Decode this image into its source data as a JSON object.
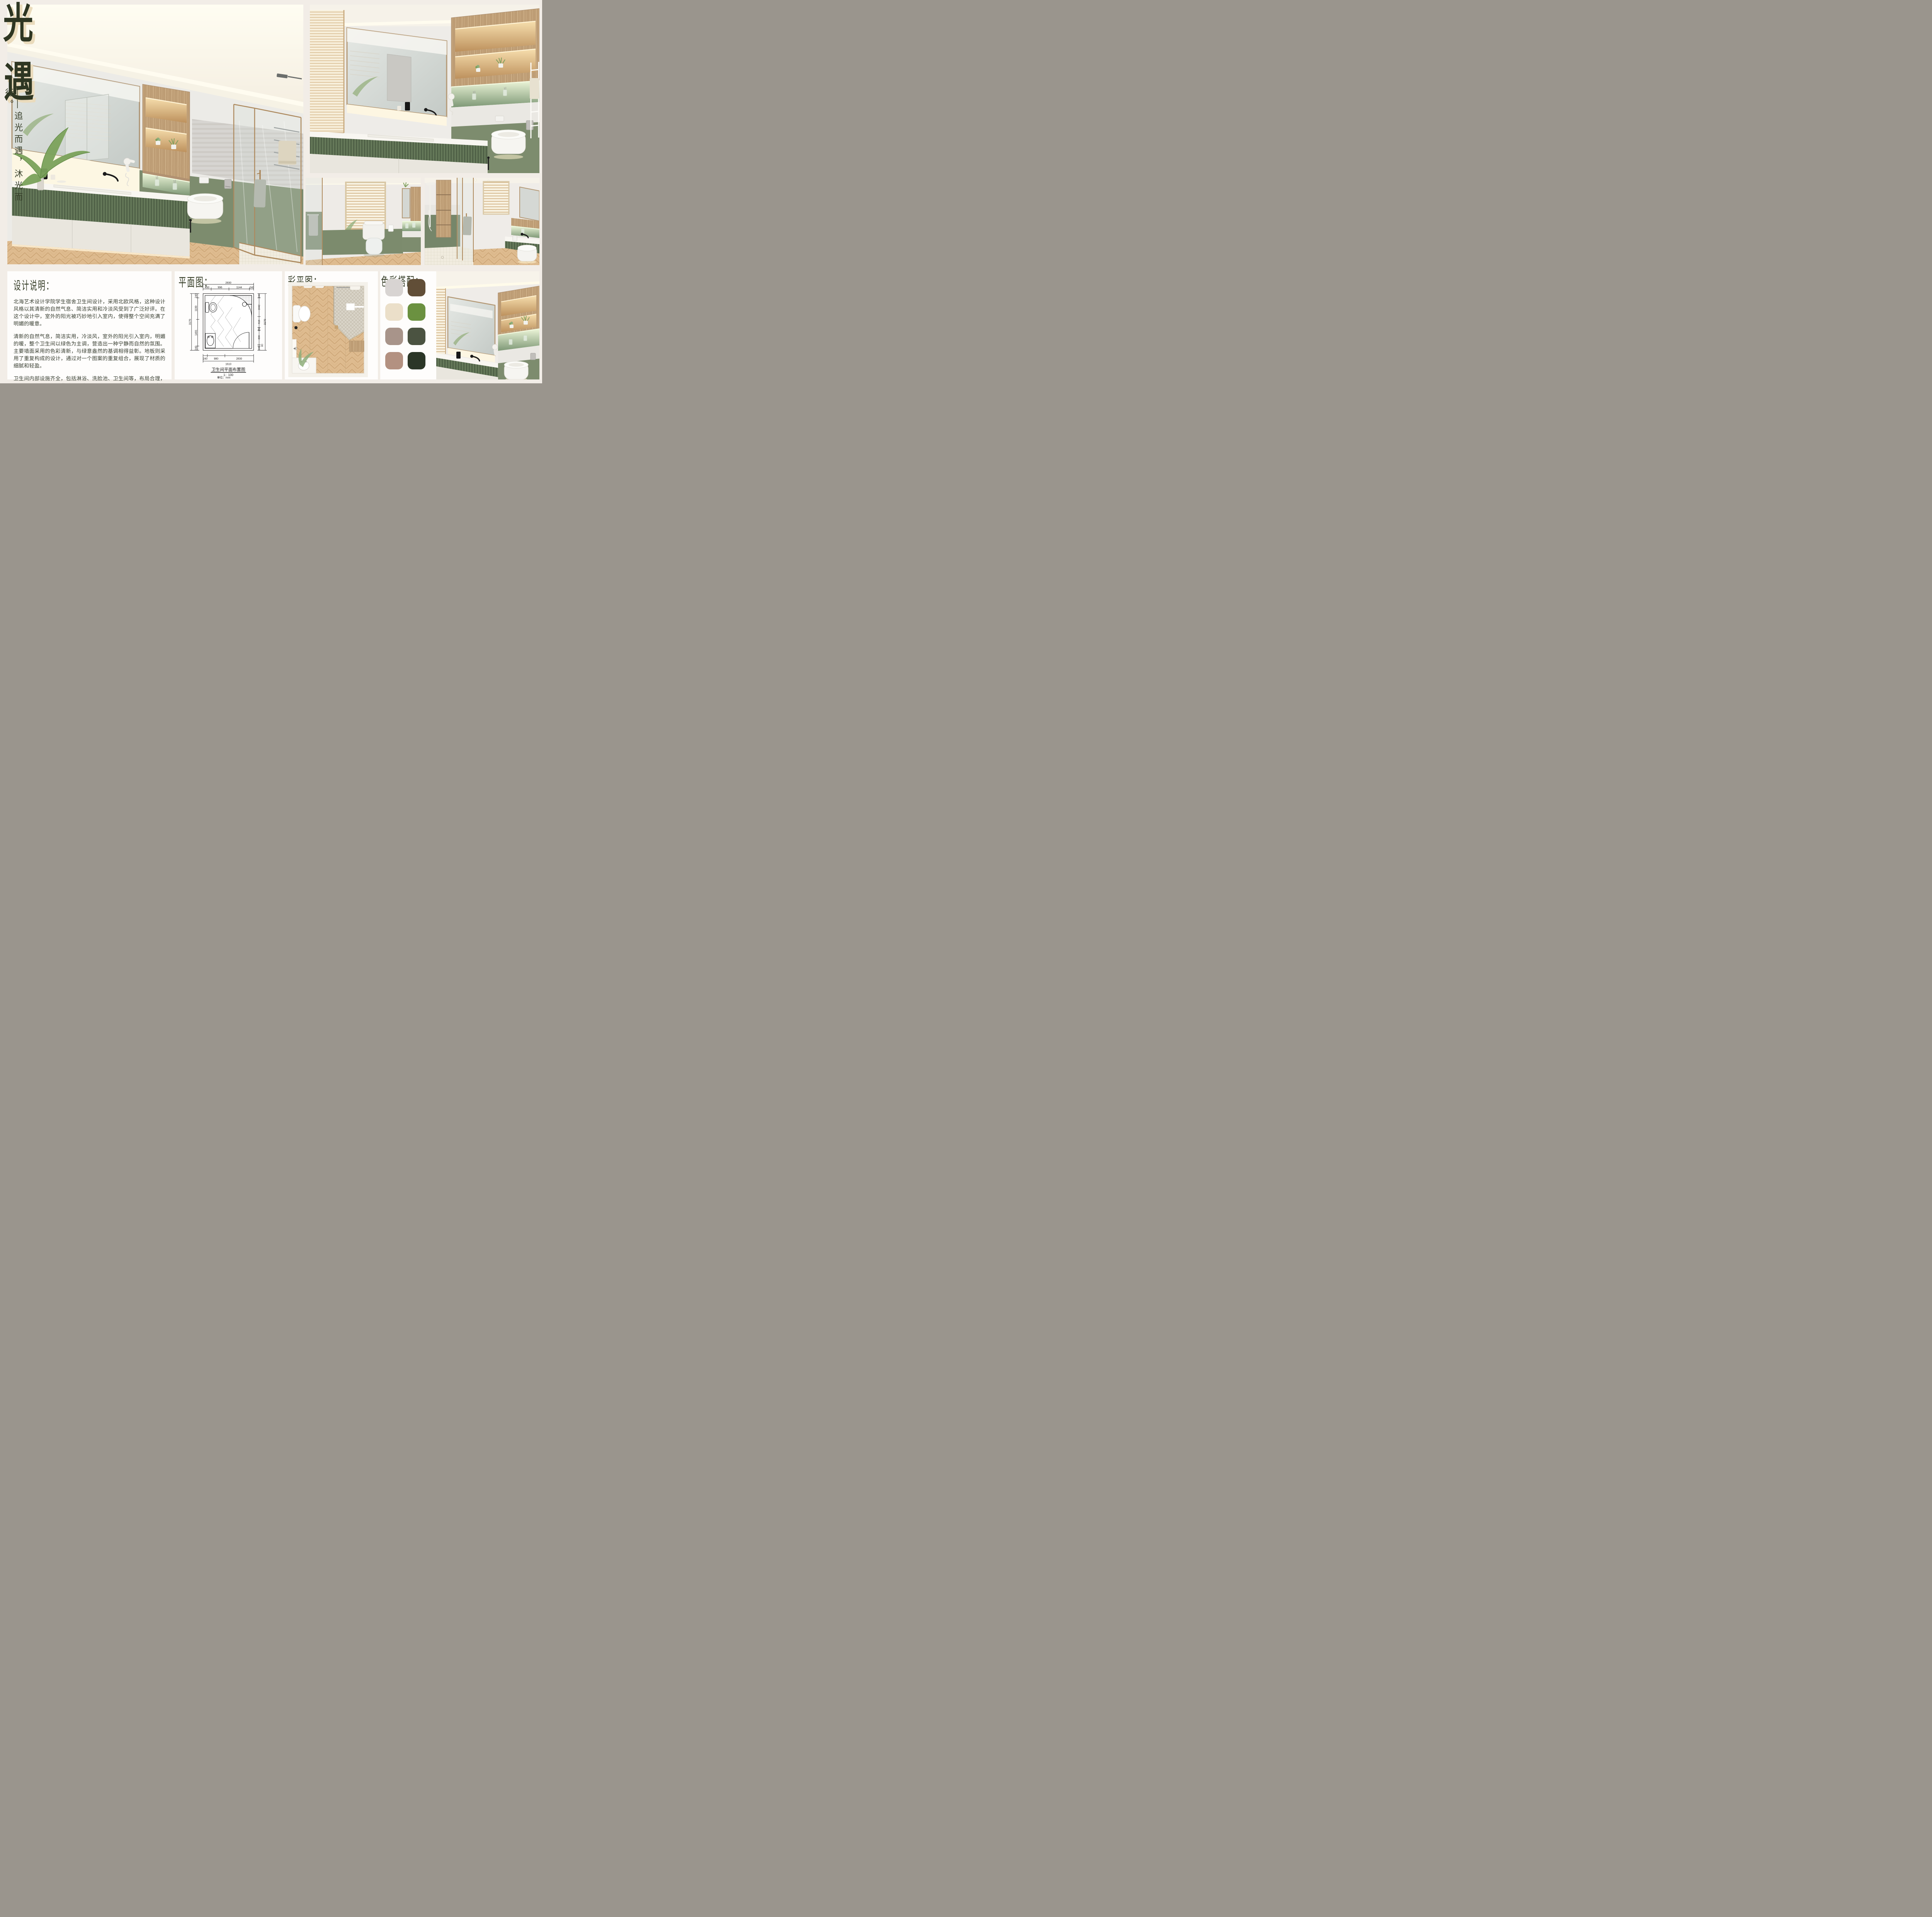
{
  "board": {
    "background": "#f2ede7",
    "text_dark_green": "#39412b",
    "accent_green_wall": "#7d8c6e",
    "accent_green_cabinet": "#5e7153",
    "accent_wood": "#c2a27a"
  },
  "title": {
    "char1": "光",
    "char2": "遇",
    "subtitle": "——追光而遇，沐光而行。"
  },
  "design_notes": {
    "heading": "设计说明：",
    "paragraphs": [
      "北海艺术设计学院学生宿舍卫生间设计，采用北欧风格，这种设计风格以其清新的自然气息、简洁实用和冷淡风受到了广泛好评。在这个设计中，室外的阳光被巧妙地引入室内，使得整个空间充满了明媚的暖意。",
      "清新的自然气息，简洁实用，冷淡风，室外的阳光引入室内，明媚的暖，整个卫生间以绿色为主调，营造出一种宁静而自然的氛围。主要墙面采用的色彩清新，与绿意盎然的基调相得益彰。地板则采用了重复构成的设计，通过对一个图案的重复组合，展现了材质的细腻和轻盈。",
      "卫生间内部设施齐全，包括淋浴、洗脸池、卫生间等，布局合理，使用起来十分便利。此外，卫生间还采用了明亮的窗户，使阳光能够充分进入，增加了空间的明亮度。"
    ]
  },
  "plan": {
    "heading": "平面图：",
    "title": "卫生间平面布置图",
    "scale": "1：100",
    "unit": "单位：mm",
    "dims": {
      "top_total": "2830",
      "top_segments": [
        "450",
        "996",
        "1144",
        "240"
      ],
      "bottom_segments": [
        "240",
        "980",
        "1610"
      ],
      "bottom_total": "2830",
      "left_segments": [
        "240",
        "1199",
        "1491",
        "240"
      ],
      "left_total": "3170",
      "right_segments": [
        "240",
        "1042",
        "618",
        "150",
        "800",
        "80",
        "240"
      ],
      "right_total": "3170"
    }
  },
  "color_plan": {
    "heading": "彩平图："
  },
  "palette": {
    "heading": "色彩搭配：",
    "swatches": [
      "#d8d4d2",
      "#614e37",
      "#ebdfc9",
      "#6b9140",
      "#a8948a",
      "#4b5341",
      "#b39181",
      "#2b3627"
    ]
  }
}
